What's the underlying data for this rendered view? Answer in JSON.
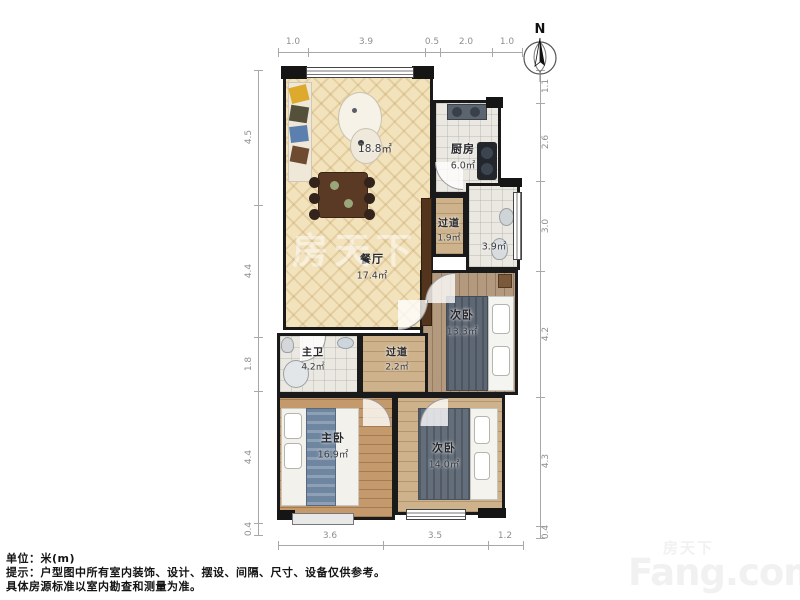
{
  "compass": {
    "label": "N"
  },
  "dimensions": {
    "top": [
      "1.0",
      "3.9",
      "0.5",
      "2.0",
      "1.0"
    ],
    "left": [
      "4.5",
      "4.4",
      "1.8",
      "4.4",
      "0.4"
    ],
    "right": [
      "1.1",
      "2.6",
      "3.0",
      "4.2",
      "4.3",
      "0.4"
    ],
    "bottom": [
      "3.6",
      "3.5",
      "1.2"
    ]
  },
  "rooms": [
    {
      "id": "living",
      "label": "",
      "area": "18.8㎡"
    },
    {
      "id": "dining",
      "label": "餐厅",
      "area": "17.4㎡"
    },
    {
      "id": "kitchen",
      "label": "厨房",
      "area": "6.0㎡"
    },
    {
      "id": "hallway-north",
      "label": "过道",
      "area": "1.9㎡"
    },
    {
      "id": "bathroom-north",
      "label": "",
      "area": "3.9㎡"
    },
    {
      "id": "bedroom-east",
      "label": "次卧",
      "area": "13.3㎡"
    },
    {
      "id": "master-bathroom",
      "label": "主卫",
      "area": "4.2㎡"
    },
    {
      "id": "hallway-south",
      "label": "过道",
      "area": "2.2㎡"
    },
    {
      "id": "master-bedroom",
      "label": "主卧",
      "area": "16.9㎡"
    },
    {
      "id": "bedroom-south",
      "label": "次卧",
      "area": "14.0㎡"
    }
  ],
  "footer": {
    "line1": "单位：米(m)",
    "line2": "提示：户型图中所有室内装饰、设计、摆设、间隔、尺寸、设备仅供参考。",
    "line3": "具体房源标准以室内勘查和测量为准。"
  },
  "watermark": {
    "center": "房天下",
    "brand_cn": "房天下",
    "brand_en": "Fang.com"
  },
  "colors": {
    "wall": "#1a1a1a",
    "living_floor": "#f2e3bd",
    "wood_floor": "#c49a6c",
    "tile_floor": "#eae8e1",
    "dim_line": "#a8a8a8"
  }
}
